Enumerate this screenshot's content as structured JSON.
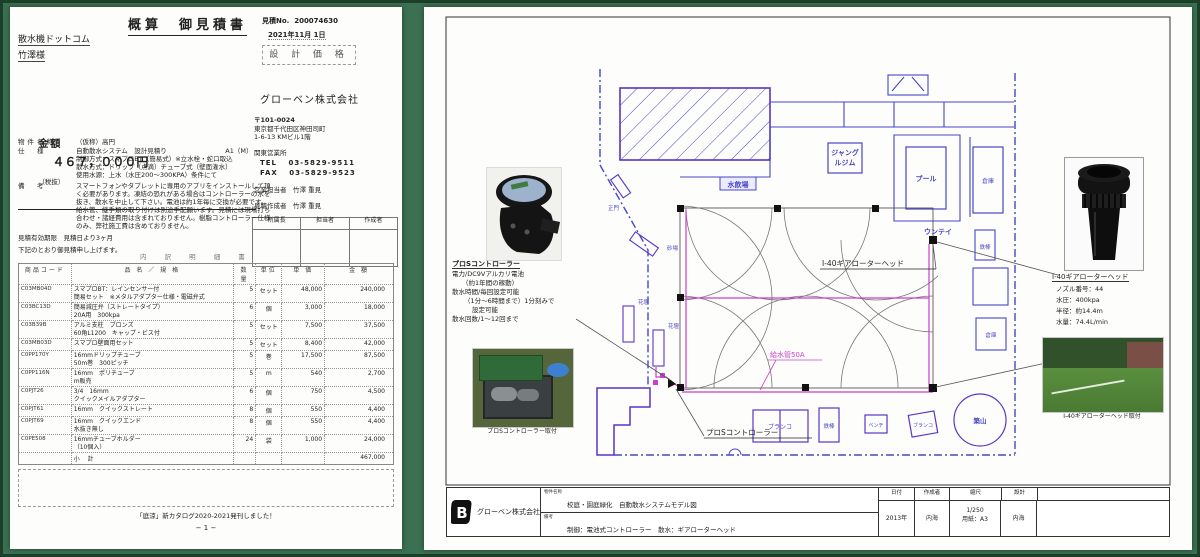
{
  "colors": {
    "background": "#3b7152",
    "blueprint_blue": "#4646c8",
    "blueprint_purple": "#5a35c8",
    "pipe_magenta": "#cc3ecc"
  },
  "left_doc": {
    "title": "概算　御見積書",
    "quote_no": "見積No.  200074630",
    "date": "2021年11月 1日",
    "stamp": "設 計 価 格",
    "addressee1": "散水機ドットコム",
    "addressee2": "竹澤様",
    "amount_label": "金額",
    "amount_value": "４６７，０００円",
    "amount_note": "（税抜）",
    "company": {
      "name": "グローベン株式会社",
      "zip": "〒101-0024",
      "addr1": "東京都千代田区神田司町",
      "addr2": "1-6-13 KMビル1階",
      "office": "関東営業所",
      "tel": "TEL　 03-5829-9511",
      "fax": "FAX　 03-5829-9523",
      "sales": "営業担当者　竹澤 重見",
      "author": "見積作成者　竹澤 重見"
    },
    "approval_headers": [
      "所属長",
      "担当者",
      "作成者"
    ],
    "property": {
      "name_label": "物件名称",
      "name": "（仮称）高円",
      "spec_label": "仕　様",
      "spec_lines": [
        "自動散水システム　設計見積り　　　　　　　　　A1（M）",
        "制御方式：スマプロBT（簡易式）※立水栓・蛇口取込",
        "散水方式：ドリップ（点滴）チューブ式（壁面潅水）",
        "使用水源：上水（水圧200～300KPA）条件にて"
      ],
      "biko_label": "備　考",
      "biko_lines": [
        "スマートフォンやタブレットに専用のアプリをインストールして頂",
        "く必要があります。凍結の恐れがある場合はコントローラーの水を",
        "抜き、散水を中止して下さい。電池は約1年毎に交換が必要です。",
        "給水管、継手類の取り付けは別途手配願います。見積には現場打ち",
        "合わせ・諸経費用は含まれておりません。樹脂コントローラー仕様",
        "のみ、弊社施工費は含めておりません。"
      ],
      "validity": "見積有効期限　見積日より3ヶ月",
      "intro": "下記のとおり御見積申し上げます。",
      "detail_header": "内 訳 明 細 書"
    },
    "table": {
      "headers": [
        "商品コード",
        "品 名 ／ 規 格",
        "数 量",
        "単位",
        "単 価",
        "金 額"
      ],
      "rows": [
        {
          "code": "C03MB04D",
          "name1": "スマプロBT：レインセンサー付",
          "name2": "簡易セット　※メタルアダプター仕様・電磁弁式",
          "qty": "5",
          "unit": "セット",
          "price": "48,000",
          "amount": "240,000"
        },
        {
          "code": "C03BC13D",
          "name1": "簡易減圧弁（ストレートタイプ）",
          "name2": "20A用　300kpa",
          "qty": "6",
          "unit": "個",
          "price": "3,000",
          "amount": "18,000"
        },
        {
          "code": "C03B39B",
          "name1": "アルミ支柱　ブロンズ",
          "name2": "60角L1200　キャップ・ビス付",
          "qty": "5",
          "unit": "セット",
          "price": "7,500",
          "amount": "37,500"
        },
        {
          "code": "C03MB03D",
          "name1": "スマプロ壁面用セット",
          "name2": "",
          "qty": "5",
          "unit": "セット",
          "price": "8,400",
          "amount": "42,000"
        },
        {
          "code": "C0PP170Y",
          "name1": "16mmドリップチューブ",
          "name2": "50m巻　300ピッチ",
          "qty": "5",
          "unit": "巻",
          "price": "17,500",
          "amount": "87,500"
        },
        {
          "code": "C0PP116N",
          "name1": "16mm　ポリチューブ",
          "name2": "m販売",
          "qty": "5",
          "unit": "m",
          "price": "540",
          "amount": "2,700"
        },
        {
          "code": "C0PJT26",
          "name1": "3/4　16mm",
          "name2": "クイックメイルアダプター",
          "qty": "6",
          "unit": "個",
          "price": "750",
          "amount": "4,500"
        },
        {
          "code": "C0PJT61",
          "name1": "16mm　クイックストレート",
          "name2": "",
          "qty": "8",
          "unit": "個",
          "price": "550",
          "amount": "4,400"
        },
        {
          "code": "C0PJT69",
          "name1": "16mm　クイックエンド",
          "name2": "水抜き無し",
          "qty": "8",
          "unit": "個",
          "price": "550",
          "amount": "4,400"
        },
        {
          "code": "C0PE508",
          "name1": "16mmチューブホルダー",
          "name2": "（10個入）",
          "qty": "24",
          "unit": "袋",
          "price": "1,000",
          "amount": "24,000"
        }
      ],
      "subtotal_label": "小 計",
      "subtotal": "467,000"
    },
    "footer1": "「庭涼」新カタログ2020-2021発刊しました！",
    "footer2": "− 1 −"
  },
  "right_doc": {
    "plan": {
      "school_box_label": "水飲場",
      "jungle1": "ジャング",
      "jungle2": "ルジム",
      "pool": "プール",
      "souko_tall": "倉庫",
      "box_r1": "鉄棒",
      "box_r3": "倉庫",
      "untei": "ウンテイ",
      "mound": "築山",
      "swing1": "ブランコ",
      "swing2": "ブランコ",
      "bench": "ベンチ",
      "bars": "鉄棒",
      "sand": "砂場",
      "flower1": "花壇",
      "flower2": "花壇",
      "gate": "正門",
      "pipe_label": "給水管50A",
      "ctrl_label": "プロSコントローラー",
      "head_label": "I-40ギアローターヘッド"
    },
    "ctrl_note": {
      "title": "プロSコントローラー",
      "line1": "電力/DC9Vアルカリ電池",
      "line2": "（約1年間の稼動）",
      "line3": "散水時間/毎回設定可能",
      "line4": "（1分～6時間まで）1分刻みで",
      "line5": "設定可能",
      "line6": "散水回数/1～12回まで",
      "photo_caption": "プロSコントローラー取付"
    },
    "head_note": {
      "title": "I-40ギアローターヘッド",
      "spec1": "ノズル番号：44",
      "spec2": "水圧：400kpa",
      "spec3": "半径：約14.4m",
      "spec4": "水量：74.4L/min",
      "photo_caption": "I-40ギアローターヘッド取付"
    },
    "title_block": {
      "logo_letter": "B",
      "company": "グローベン株式会社",
      "name_label": "物件名称",
      "name": "校庭・園庭緑化　自動散水システムモデル図",
      "biko_label": "備考",
      "biko": "制御：電池式コントローラー　散水：ギアローターヘッド",
      "col_date": "日付",
      "col_author": "作成者",
      "col_scale": "縮尺",
      "col_design": "設計",
      "date": "2013年",
      "author": "内海",
      "scale1": "1/250",
      "scale2": "用紙：A3",
      "design": "内海"
    }
  }
}
